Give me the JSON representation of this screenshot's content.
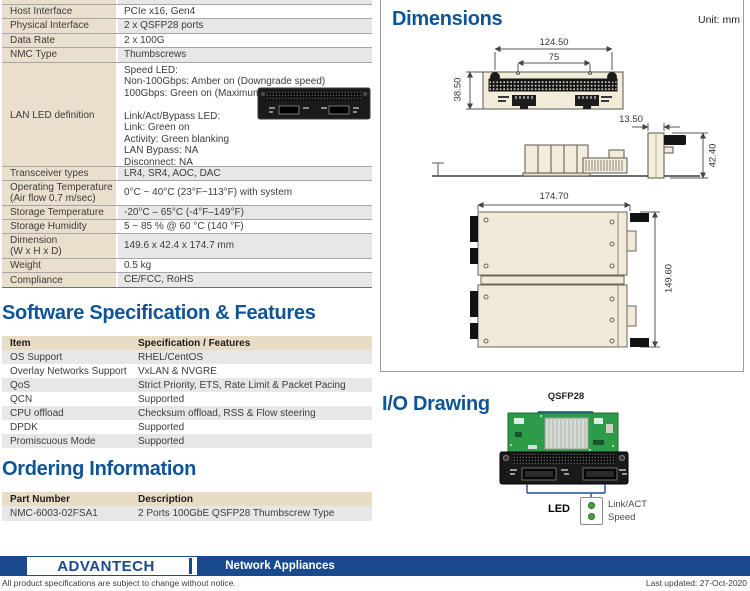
{
  "spec": {
    "rows": [
      {
        "label": "",
        "value": ""
      },
      {
        "label": "Host Interface",
        "value": "PCIe x16, Gen4"
      },
      {
        "label": "Physical Interface",
        "value": "2 x QSFP28 ports"
      },
      {
        "label": "Data Rate",
        "value": "2 x 100G"
      },
      {
        "label": "NMC Type",
        "value": "Thumbscrews"
      },
      {
        "label": "LAN LED definition",
        "value": "Speed LED:\nNon-100Gbps: Amber on (Downgrade speed)\n100Gbps: Green on (Maximum)\n\nLink/Act/Bypass LED:\nLink: Green on\nActivity: Green blanking\nLAN Bypass: NA\nDisconnect: NA"
      },
      {
        "label": "Transceiver types",
        "value": "LR4, SR4, AOC, DAC"
      },
      {
        "label": "Operating Temperature\n(Air flow 0.7 m/sec)",
        "value": "0°C ~ 40°C (23°F~113°F) with system"
      },
      {
        "label": "Storage Temperature",
        "value": "-20°C – 65°C (-4°F–149°F)"
      },
      {
        "label": "Storage Humidity",
        "value": "5 ~ 85 % @ 60 °C (140 °F)"
      },
      {
        "label": "Dimension\n(W x H x D)",
        "value": "149.6 x 42.4 x 174.7 mm"
      },
      {
        "label": "Weight",
        "value": "0.5 kg"
      },
      {
        "label": "Compliance",
        "value": "CE/FCC, RoHS"
      }
    ]
  },
  "software": {
    "title": "Software Specification & Features",
    "headers": [
      "Item",
      "Specification / Features"
    ],
    "rows": [
      [
        "OS Support",
        "RHEL/CentOS"
      ],
      [
        "Overlay Networks Support",
        "VxLAN & NVGRE"
      ],
      [
        "QoS",
        "Strict Priority, ETS, Rate Limit & Packet Pacing"
      ],
      [
        "QCN",
        "Supported"
      ],
      [
        "CPU offload",
        "Checksum offload, RSS & Flow steering"
      ],
      [
        "DPDK",
        "Supported"
      ],
      [
        "Promiscuous Mode",
        "Supported"
      ]
    ]
  },
  "ordering": {
    "title": "Ordering Information",
    "headers": [
      "Part Number",
      "Description"
    ],
    "rows": [
      [
        "NMC-6003-02FSA1",
        "2 Ports 100GbE QSFP28 Thumbscrew Type"
      ]
    ]
  },
  "dimensions": {
    "title": "Dimensions",
    "unit": "Unit: mm",
    "front_width": "124.50",
    "front_inner_width": "75",
    "front_height": "38.50",
    "side_offset": "13.50",
    "side_height": "42.40",
    "top_depth": "174.70",
    "top_width": "149.60"
  },
  "io": {
    "title": "I/O Drawing",
    "connector_label": "QSFP28",
    "led_label": "LED",
    "led_legend": [
      "Link/ACT",
      "Speed"
    ]
  },
  "footer": {
    "brand": "ADVANTECH",
    "category": "Network Appliances",
    "note": "All product specifications are subject to change without notice.",
    "updated": "Last updated: 27-Oct-2020"
  },
  "colors": {
    "heading_blue": "#0f5596",
    "footer_navy": "#1a4a8e",
    "label_beige": "#eadfcc",
    "stripe_gray": "#e7e7e7",
    "led_green": "#46a33c"
  }
}
